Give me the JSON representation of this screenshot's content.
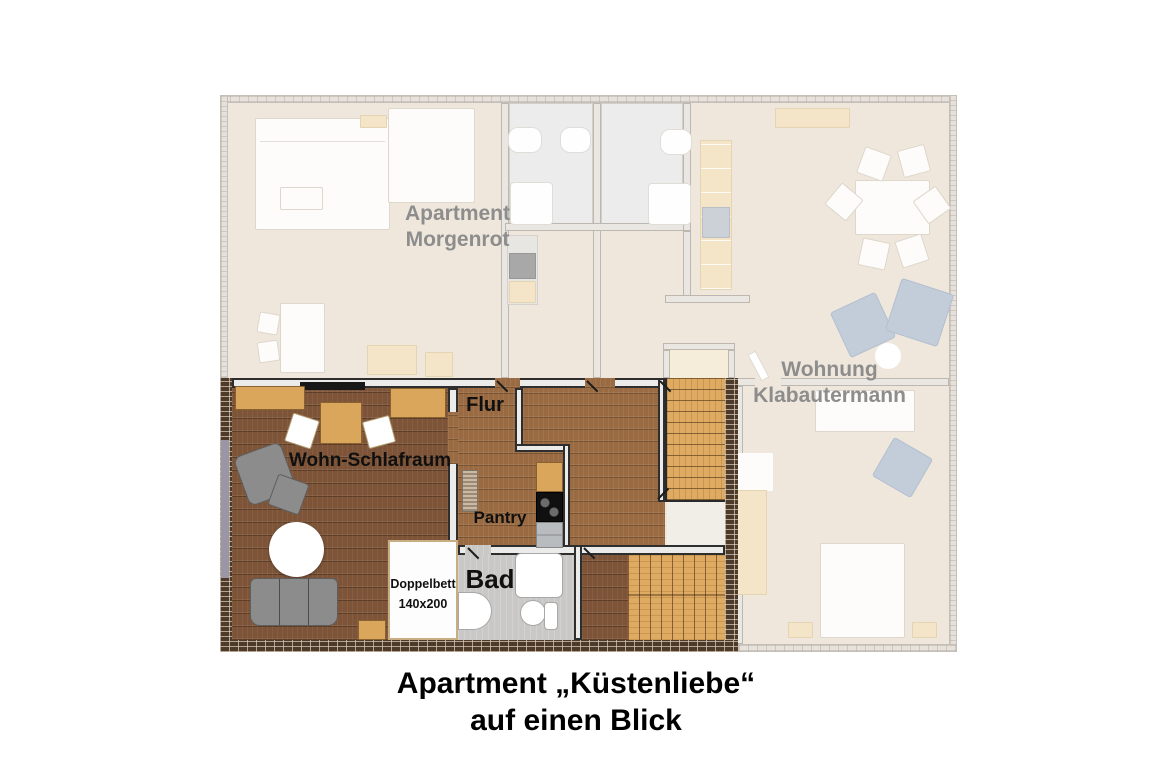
{
  "title": {
    "line1": "Apartment „Küstenliebe“",
    "line2": "auf einen Blick"
  },
  "background_units": {
    "morgenrot": {
      "line1": "Apartment",
      "line2": "Morgenrot"
    },
    "klabautermann": {
      "line1": "Wohnung",
      "line2": "Klabautermann"
    }
  },
  "rooms": {
    "wohn_schlafraum": {
      "label": "Wohn-Schlafraum"
    },
    "flur": {
      "label": "Flur"
    },
    "pantry": {
      "label": "Pantry"
    },
    "bad": {
      "label": "Bad"
    }
  },
  "furniture": {
    "doppelbett": {
      "line1": "Doppelbett",
      "line2": "140x200"
    }
  },
  "colors": {
    "floor_dark_wood": "#7d5438",
    "floor_mid_wood": "#9a6b42",
    "stairs_wood": "#dfab63",
    "bath_floor": "#cac8c6",
    "brick_wall": "#4e3a29",
    "faded_floor": "#efe7db",
    "window_strip": "#9b95a8",
    "label_gray": "#8d8d8d",
    "label_black": "#101010"
  }
}
